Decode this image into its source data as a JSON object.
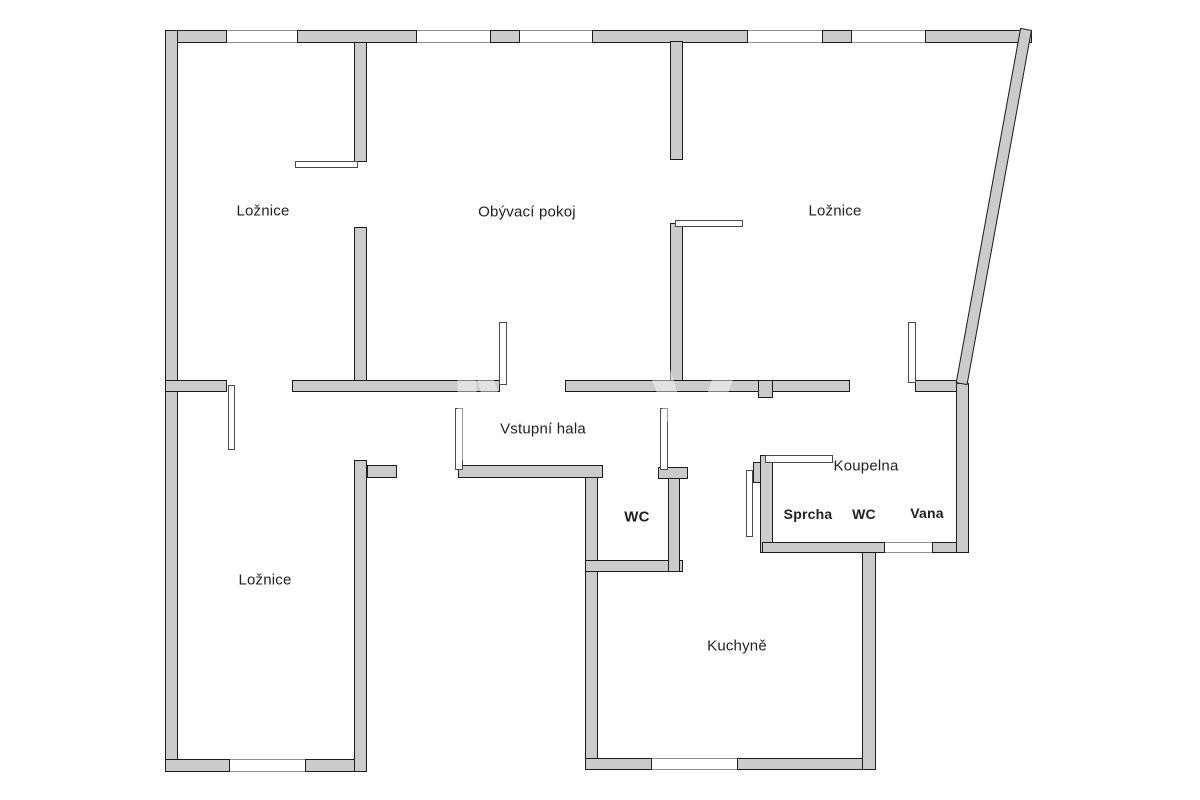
{
  "image": {
    "width": 1200,
    "height": 800,
    "background": "#ffffff"
  },
  "floorplan": {
    "colors": {
      "wall_fill": "#cbcbcb",
      "wall_border": "#1c1c1c",
      "window_line": "#8f8f8f",
      "door_border": "#4a4a4a",
      "label_color": "#1f1f1f",
      "background": "#ffffff"
    },
    "watermark": {
      "text": "MV",
      "opacity": 0.45
    },
    "room_labels": [
      {
        "name": "room-label-loznice-top-left",
        "text": "Ložnice",
        "x": 263,
        "y": 211,
        "size": 15,
        "weight": 400
      },
      {
        "name": "room-label-obyvaci-pokoj",
        "text": "Obývací pokoj",
        "x": 527,
        "y": 212,
        "size": 15,
        "weight": 400
      },
      {
        "name": "room-label-loznice-top-right",
        "text": "Ložnice",
        "x": 835,
        "y": 211,
        "size": 15,
        "weight": 400
      },
      {
        "name": "room-label-loznice-bottom-left",
        "text": "Ložnice",
        "x": 265,
        "y": 580,
        "size": 15,
        "weight": 400
      },
      {
        "name": "room-label-vstupni-hala",
        "text": "Vstupní hala",
        "x": 543,
        "y": 429,
        "size": 15,
        "weight": 400
      },
      {
        "name": "room-label-wc",
        "text": "WC",
        "x": 637,
        "y": 517,
        "size": 15,
        "weight": 600
      },
      {
        "name": "room-label-koupelna",
        "text": "Koupelna",
        "x": 866,
        "y": 466,
        "size": 15,
        "weight": 400
      },
      {
        "name": "fixture-label-sprcha",
        "text": "Sprcha",
        "x": 808,
        "y": 514,
        "size": 14,
        "weight": 700
      },
      {
        "name": "fixture-label-wc",
        "text": "WC",
        "x": 864,
        "y": 514,
        "size": 14,
        "weight": 700
      },
      {
        "name": "fixture-label-vana",
        "text": "Vana",
        "x": 927,
        "y": 513,
        "size": 14,
        "weight": 700
      },
      {
        "name": "room-label-kuchyne",
        "text": "Kuchyně",
        "x": 737,
        "y": 646,
        "size": 15,
        "weight": 400
      }
    ],
    "walls": [
      {
        "name": "wall-top-segment-1",
        "x": 165,
        "y": 30,
        "w": 62,
        "h": 13
      },
      {
        "name": "wall-top-segment-2",
        "x": 297,
        "y": 30,
        "w": 120,
        "h": 13
      },
      {
        "name": "wall-top-segment-3",
        "x": 490,
        "y": 30,
        "w": 30,
        "h": 13
      },
      {
        "name": "wall-top-segment-4",
        "x": 592,
        "y": 30,
        "w": 156,
        "h": 13
      },
      {
        "name": "wall-top-segment-5",
        "x": 822,
        "y": 30,
        "w": 30,
        "h": 13
      },
      {
        "name": "wall-top-segment-6",
        "x": 925,
        "y": 30,
        "w": 107,
        "h": 13
      },
      {
        "name": "wall-exterior-left",
        "x": 165,
        "y": 30,
        "w": 13,
        "h": 742
      },
      {
        "name": "wall-bottom-left-1",
        "x": 165,
        "y": 759,
        "w": 65,
        "h": 13
      },
      {
        "name": "wall-bottom-left-2",
        "x": 305,
        "y": 759,
        "w": 62,
        "h": 13
      },
      {
        "name": "wall-bedroom-bl-right",
        "x": 354,
        "y": 460,
        "w": 13,
        "h": 312
      },
      {
        "name": "wall-bedroom-tl-right-up",
        "x": 354,
        "y": 42,
        "w": 13,
        "h": 120
      },
      {
        "name": "wall-bedroom-tl-right-low",
        "x": 354,
        "y": 227,
        "w": 13,
        "h": 165
      },
      {
        "name": "wall-living-tr-up",
        "x": 670,
        "y": 41,
        "w": 13,
        "h": 119
      },
      {
        "name": "wall-living-tr-low",
        "x": 670,
        "y": 223,
        "w": 13,
        "h": 169
      },
      {
        "name": "wall-divider-1",
        "x": 165,
        "y": 380,
        "w": 62,
        "h": 12
      },
      {
        "name": "wall-divider-2",
        "x": 292,
        "y": 380,
        "w": 208,
        "h": 12
      },
      {
        "name": "wall-divider-3",
        "x": 565,
        "y": 380,
        "w": 285,
        "h": 12
      },
      {
        "name": "wall-divider-4",
        "x": 915,
        "y": 380,
        "w": 48,
        "h": 12
      },
      {
        "name": "wall-divider-stub",
        "x": 758,
        "y": 380,
        "w": 15,
        "h": 18
      },
      {
        "name": "wall-hall-stub",
        "x": 367,
        "y": 465,
        "w": 30,
        "h": 13
      },
      {
        "name": "wall-hall-bottom",
        "x": 458,
        "y": 465,
        "w": 145,
        "h": 13
      },
      {
        "name": "wall-kitchen-left",
        "x": 585,
        "y": 477,
        "w": 13,
        "h": 293
      },
      {
        "name": "wall-wc-bottom",
        "x": 585,
        "y": 560,
        "w": 98,
        "h": 12
      },
      {
        "name": "wall-wc-right",
        "x": 668,
        "y": 472,
        "w": 12,
        "h": 100
      },
      {
        "name": "wall-wc-right-cap",
        "x": 658,
        "y": 467,
        "w": 30,
        "h": 12
      },
      {
        "name": "wall-kitchen-bottom-1",
        "x": 585,
        "y": 758,
        "w": 67,
        "h": 12
      },
      {
        "name": "wall-kitchen-bottom-2",
        "x": 737,
        "y": 758,
        "w": 139,
        "h": 12
      },
      {
        "name": "wall-kitchen-right",
        "x": 862,
        "y": 542,
        "w": 14,
        "h": 228
      },
      {
        "name": "wall-bathroom-left",
        "x": 760,
        "y": 455,
        "w": 13,
        "h": 98
      },
      {
        "name": "wall-bathroom-left-stub",
        "x": 753,
        "y": 462,
        "w": 8,
        "h": 21
      },
      {
        "name": "wall-bathroom-bottom-1",
        "x": 762,
        "y": 542,
        "w": 123,
        "h": 11
      },
      {
        "name": "wall-bathroom-bottom-2",
        "x": 932,
        "y": 542,
        "w": 36,
        "h": 11
      },
      {
        "name": "wall-exterior-right",
        "x": 956,
        "y": 383,
        "w": 13,
        "h": 170
      }
    ],
    "diagonal_wall": {
      "name": "wall-exterior-diagonal",
      "x": 1020,
      "y": 30,
      "w": 12,
      "h": 361,
      "angle": 10.3
    },
    "windows": [
      {
        "name": "window-top-1",
        "x": 227,
        "y": 30,
        "w": 70,
        "h": 13
      },
      {
        "name": "window-top-2",
        "x": 417,
        "y": 30,
        "w": 73,
        "h": 13
      },
      {
        "name": "window-top-3",
        "x": 520,
        "y": 30,
        "w": 72,
        "h": 13
      },
      {
        "name": "window-top-4",
        "x": 748,
        "y": 30,
        "w": 74,
        "h": 13
      },
      {
        "name": "window-top-5",
        "x": 852,
        "y": 30,
        "w": 73,
        "h": 13
      },
      {
        "name": "window-bedroom-bl",
        "x": 230,
        "y": 759,
        "w": 75,
        "h": 13
      },
      {
        "name": "window-kitchen",
        "x": 652,
        "y": 758,
        "w": 85,
        "h": 12
      },
      {
        "name": "window-bathroom",
        "x": 885,
        "y": 542,
        "w": 47,
        "h": 11
      }
    ],
    "doors": [
      {
        "name": "door-leaf-bedrooms-left",
        "x": 228,
        "y": 385,
        "w": 7,
        "h": 65
      },
      {
        "name": "door-leaf-bedroom-tl-living",
        "x": 295,
        "y": 161,
        "w": 63,
        "h": 7
      },
      {
        "name": "door-leaf-living-room",
        "x": 499,
        "y": 322,
        "w": 8,
        "h": 63
      },
      {
        "name": "door-leaf-living-bedroom-tr",
        "x": 675,
        "y": 220,
        "w": 68,
        "h": 7
      },
      {
        "name": "door-leaf-bedroom-tr",
        "x": 908,
        "y": 322,
        "w": 8,
        "h": 61
      },
      {
        "name": "door-leaf-entrance",
        "x": 455,
        "y": 408,
        "w": 8,
        "h": 62
      },
      {
        "name": "door-leaf-wc",
        "x": 660,
        "y": 408,
        "w": 8,
        "h": 62
      },
      {
        "name": "door-leaf-bathroom",
        "x": 765,
        "y": 455,
        "w": 68,
        "h": 8
      },
      {
        "name": "door-leaf-corridor",
        "x": 746,
        "y": 470,
        "w": 7,
        "h": 67
      }
    ]
  }
}
